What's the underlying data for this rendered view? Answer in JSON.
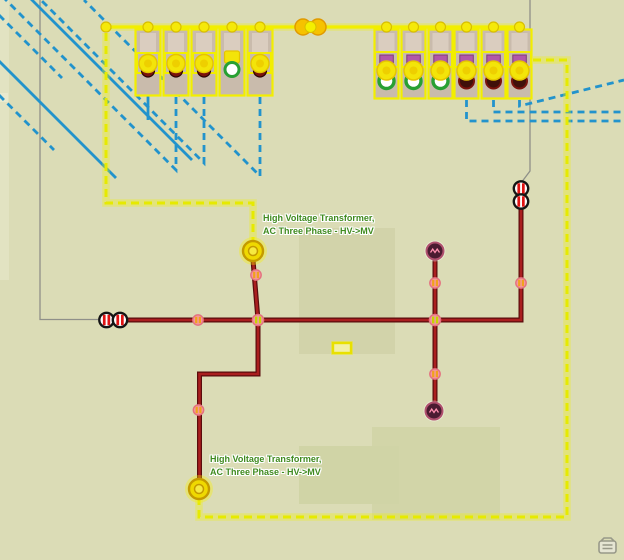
{
  "view": {
    "type": "utility-network-schematic-map",
    "labels": {
      "transformer1": {
        "line1": "High Voltage Transformer,",
        "line2": "AC Three Phase - HV->MV"
      },
      "transformer2": {
        "line1": "High Voltage Transformer,",
        "line2": "AC Three Phase - HV->MV"
      }
    },
    "features": {
      "left_substation_bays": 5,
      "right_substation_bays": 6,
      "left_bay_states": [
        "closed",
        "closed",
        "closed",
        "open",
        "closed"
      ],
      "right_bay_states": [
        "open",
        "open",
        "open",
        "closed",
        "closed",
        "closed"
      ],
      "transformer_symbols": 2,
      "disconnect_switch_pairs": 2,
      "load_device_symbols": 2
    },
    "colors": {
      "background": "#dbdcb6",
      "terrain_patch": "#d2d3aa",
      "selection_yellow": "#f2ee00",
      "dashed_feeder_yellow": "#e6ea00",
      "cable_blue": "#2293cc",
      "mv_line_red": "#aa1f1f",
      "mv_line_casing": "#5a0c0c",
      "unenergized_gray": "#8f9089",
      "label_green": "#3f8a1f",
      "node_pink": "#f5989c",
      "node_bar_orange": "#f0a21c",
      "node_bar_lime": "#c6d400",
      "breaker_stripe_red": "#e01313",
      "open_device_green": "#28a032",
      "closed_device_dark": "#40100a",
      "load_device_maroon": "#4b1b31",
      "purple_marker": "#b257a9",
      "bay_fill_tan": "#c9bbac"
    },
    "icons": {
      "corner": "map-notes-icon"
    }
  }
}
